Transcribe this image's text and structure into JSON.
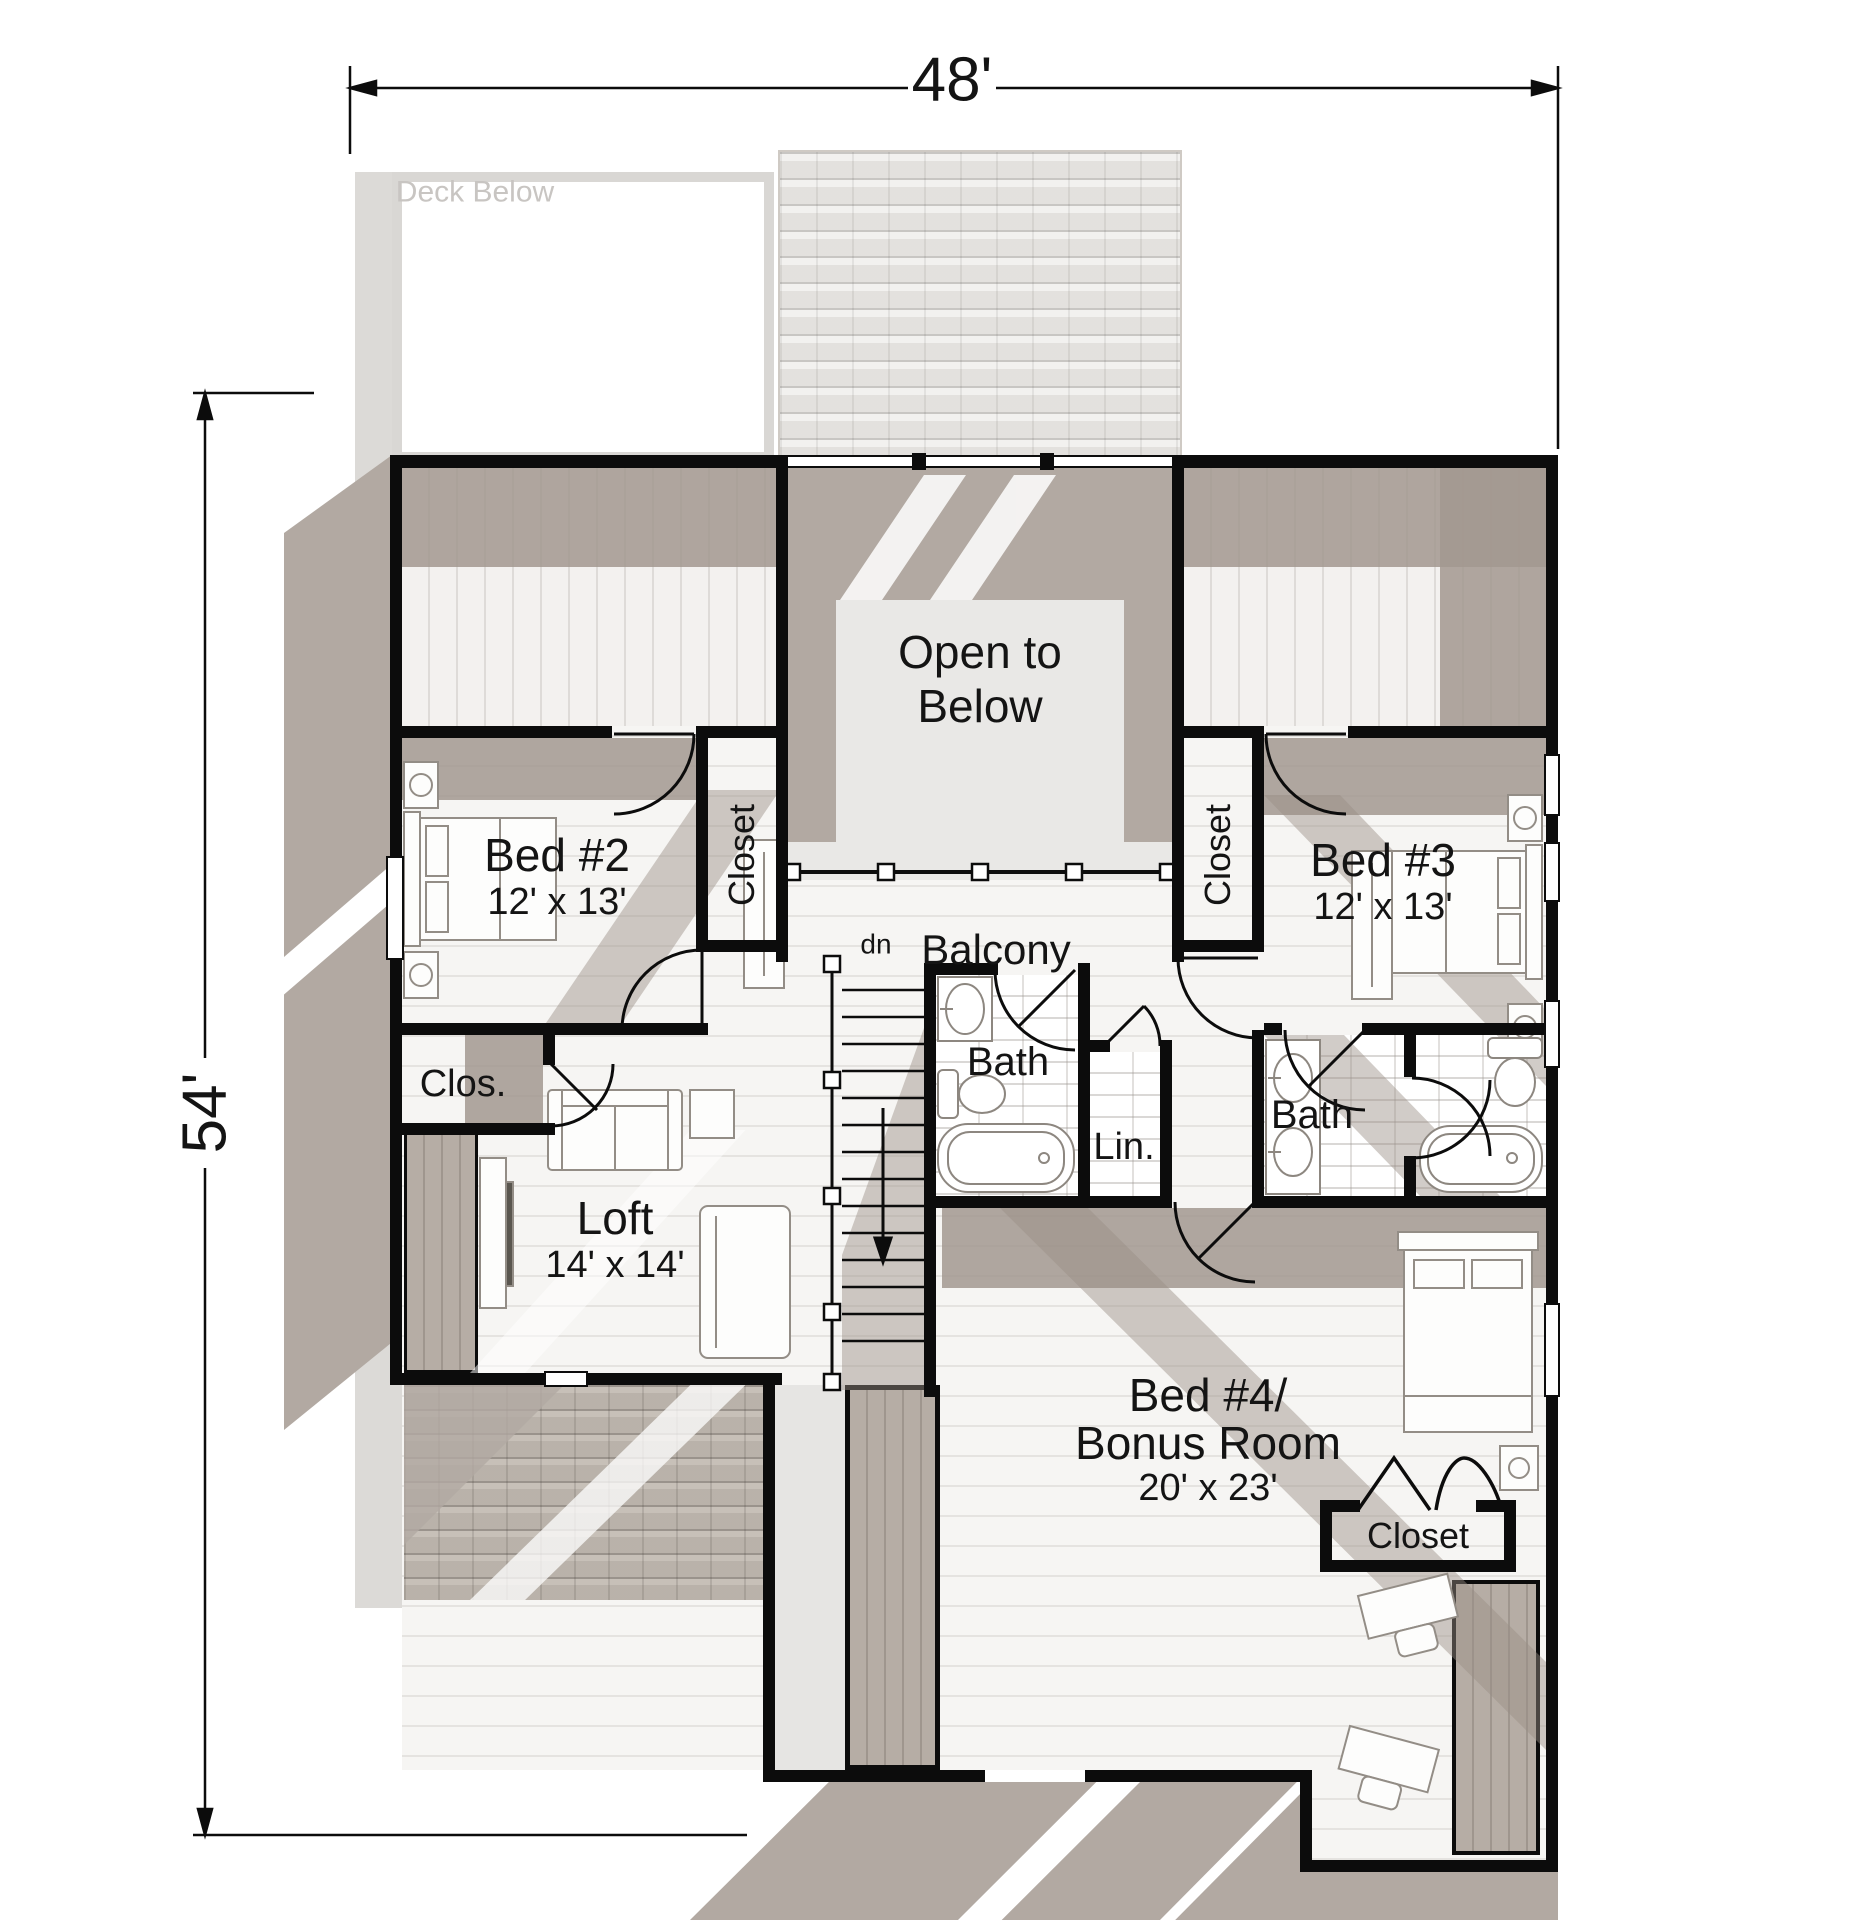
{
  "dimensions": {
    "width_label": "48'",
    "height_label": "54'"
  },
  "rooms": {
    "deck": {
      "label": "Deck Below"
    },
    "open_below": {
      "line1": "Open to",
      "line2": "Below"
    },
    "balcony": {
      "label": "Balcony"
    },
    "stairs": {
      "down_label": "dn"
    },
    "bed2": {
      "label": "Bed #2",
      "size": "12' x 13'"
    },
    "bed3": {
      "label": "Bed #3",
      "size": "12' x 13'"
    },
    "loft": {
      "label": "Loft",
      "size": "14' x 14'"
    },
    "bonus": {
      "label_line1": "Bed #4/",
      "label_line2": "Bonus Room",
      "size": "20' x 23'"
    },
    "bath_hall": {
      "label": "Bath"
    },
    "bath_bonus": {
      "label": "Bath"
    },
    "linen": {
      "label": "Lin."
    },
    "closet_bed2": {
      "label": "Closet"
    },
    "closet_bed3": {
      "label": "Closet"
    },
    "closet_hall": {
      "label": "Clos."
    },
    "closet_bonus": {
      "label": "Closet"
    }
  },
  "colors": {
    "wall": "#0c0c0c",
    "roof_shadow": "#b2a9a2",
    "backdrop": "#dcdad7",
    "open_floor": "#e9e8e6",
    "deck_text": "#c8c5c2"
  }
}
